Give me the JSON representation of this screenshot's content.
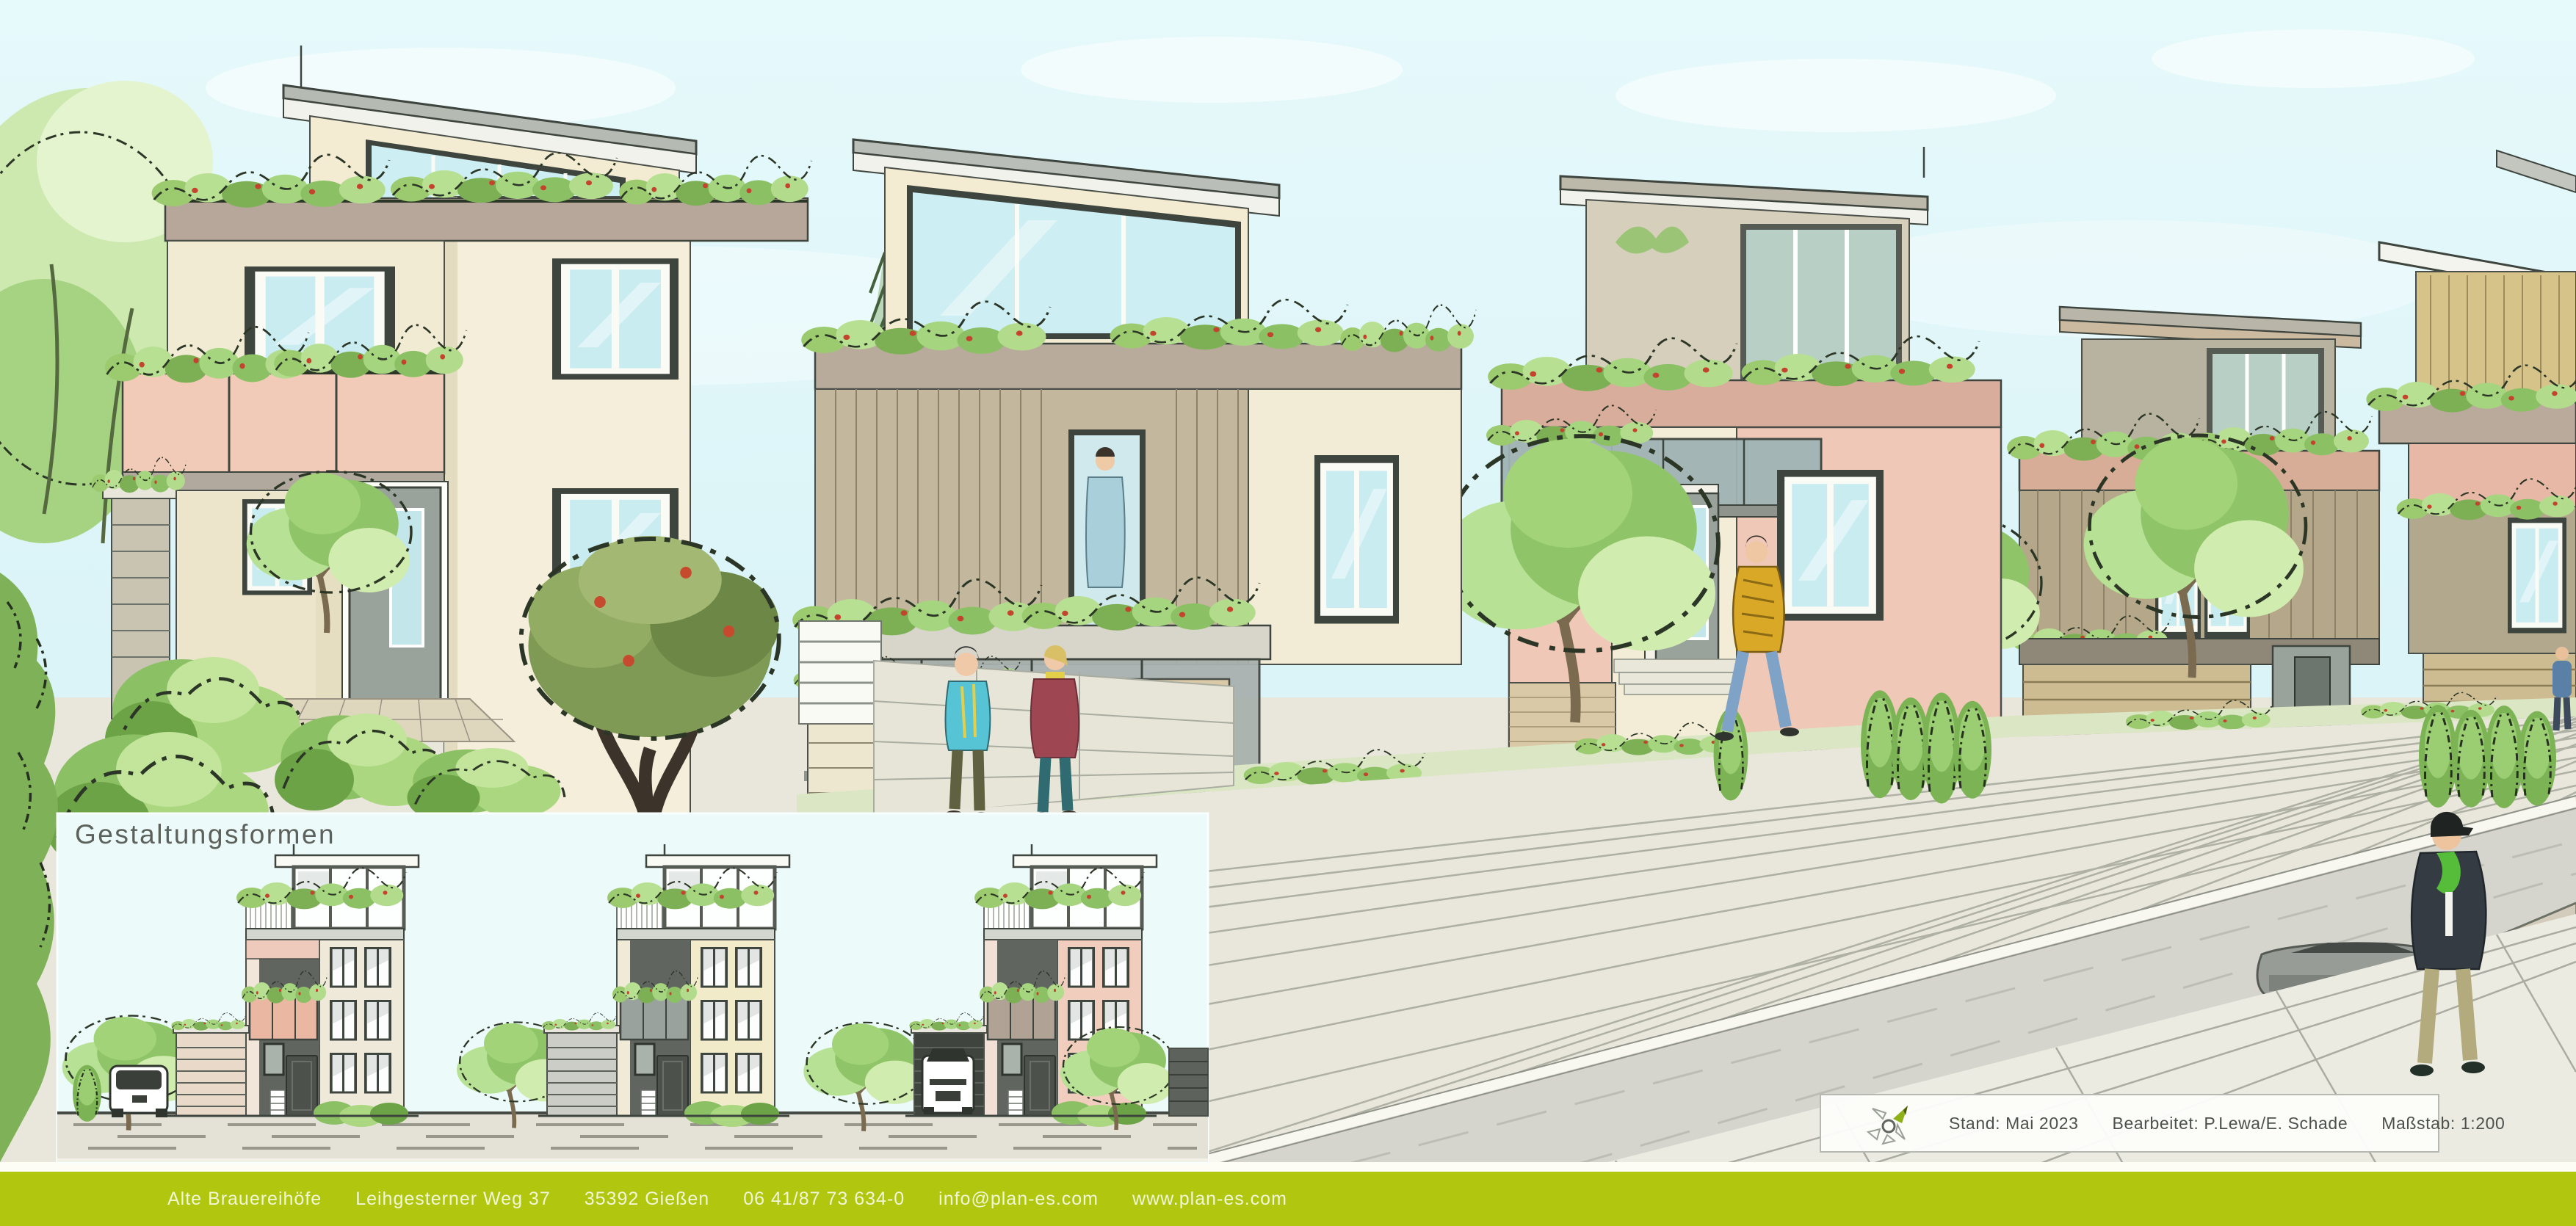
{
  "inset": {
    "title": "Gestaltungsformen"
  },
  "info_box": {
    "logo_icon": "plan-es-pinwheel-logo",
    "items": [
      "Stand: Mai 2023",
      "Bearbeitet: P.Lewa/E. Schade",
      "Maßstab: 1:200"
    ]
  },
  "footer": {
    "items": [
      "Alte Brauereihöfe",
      "Leihgesterner Weg 37",
      "35392 Gießen",
      "06 41/87 73 634-0",
      "info@plan-es.com",
      "www.plan-es.com"
    ]
  },
  "colors": {
    "footer_bar": "#b1c70f",
    "logo_green": "#8fb016",
    "sky": "#dbf4f8",
    "wall_cream": "#f3ecd2",
    "wall_pink": "#f0c9b8",
    "siding_taupe": "#bfb49a",
    "glass_cyan": "#c9ecf1",
    "vegetation_green": "#8cc065",
    "pavement": "#e9e7db",
    "street": "#d5d5cd",
    "info_text": "#4c514c",
    "title_text": "#5c615b"
  }
}
